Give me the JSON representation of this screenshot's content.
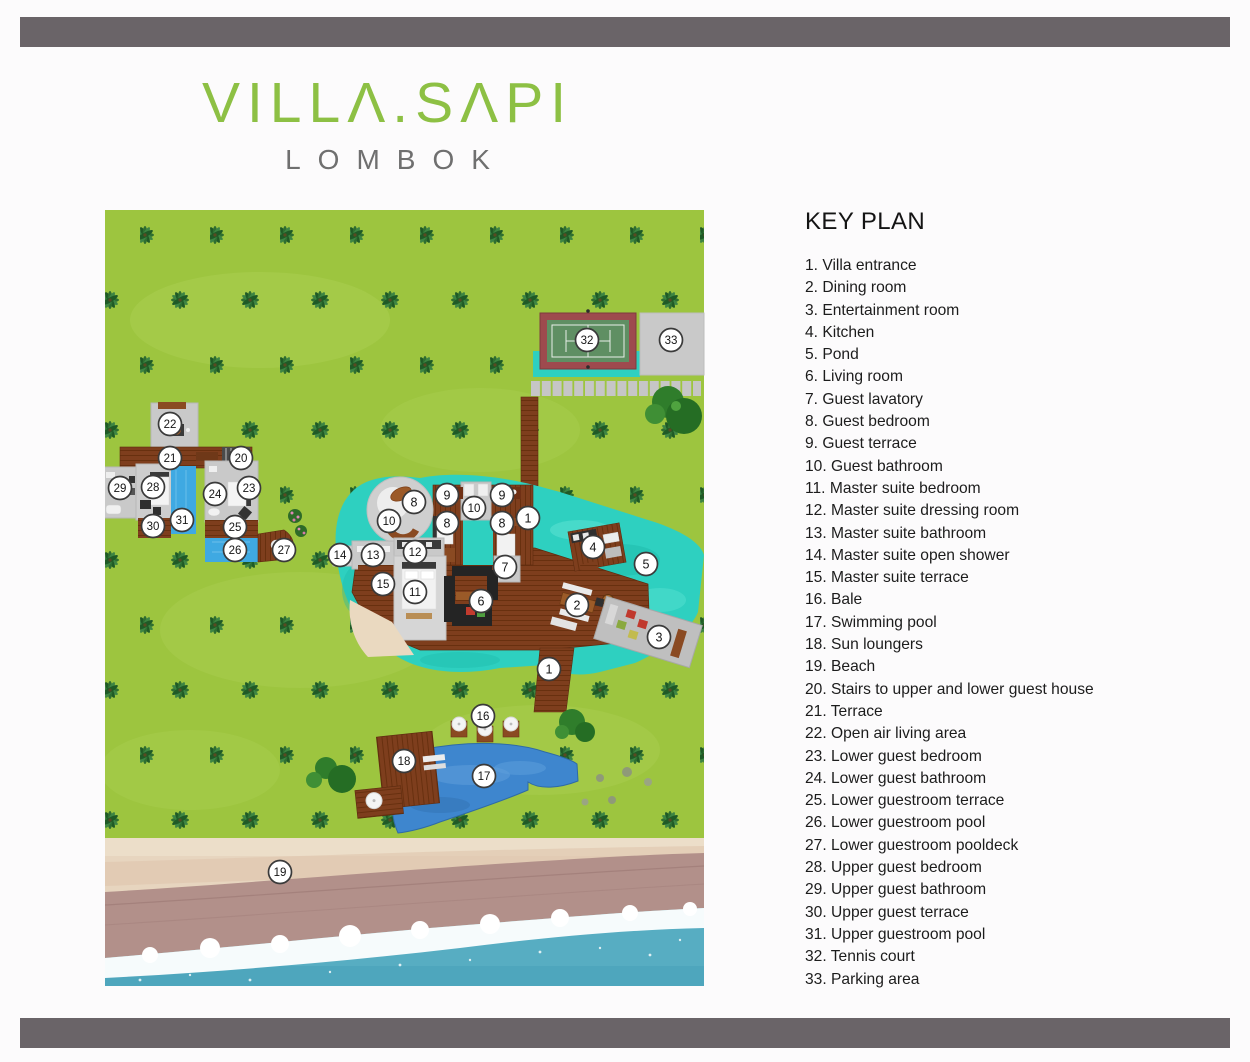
{
  "page": {
    "background": "#fcfbfc",
    "bar_color": "#6a6468"
  },
  "logo": {
    "text": "VILLA.SAPI",
    "display": "VILLΛ.SΛPI",
    "subtitle": "LOMBOK",
    "color": "#8dc044",
    "subtitle_color": "#6f6f6f"
  },
  "key_plan": {
    "title": "KEY PLAN",
    "items": [
      {
        "n": 1,
        "label": "Villa entrance"
      },
      {
        "n": 2,
        "label": "Dining room"
      },
      {
        "n": 3,
        "label": "Entertainment room"
      },
      {
        "n": 4,
        "label": "Kitchen"
      },
      {
        "n": 5,
        "label": "Pond"
      },
      {
        "n": 6,
        "label": "Living room"
      },
      {
        "n": 7,
        "label": "Guest lavatory"
      },
      {
        "n": 8,
        "label": "Guest bedroom"
      },
      {
        "n": 9,
        "label": "Guest terrace"
      },
      {
        "n": 10,
        "label": "Guest bathroom"
      },
      {
        "n": 11,
        "label": "Master suite bedroom"
      },
      {
        "n": 12,
        "label": "Master suite dressing room"
      },
      {
        "n": 13,
        "label": "Master suite bathroom"
      },
      {
        "n": 14,
        "label": "Master suite open shower"
      },
      {
        "n": 15,
        "label": "Master suite terrace"
      },
      {
        "n": 16,
        "label": "Bale"
      },
      {
        "n": 17,
        "label": "Swimming pool"
      },
      {
        "n": 18,
        "label": "Sun loungers"
      },
      {
        "n": 19,
        "label": "Beach"
      },
      {
        "n": 20,
        "label": "Stairs to upper and lower guest house"
      },
      {
        "n": 21,
        "label": "Terrace"
      },
      {
        "n": 22,
        "label": "Open air living area"
      },
      {
        "n": 23,
        "label": "Lower guest bedroom"
      },
      {
        "n": 24,
        "label": "Lower guest bathroom"
      },
      {
        "n": 25,
        "label": "Lower guestroom terrace"
      },
      {
        "n": 26,
        "label": "Lower guestroom pool"
      },
      {
        "n": 27,
        "label": "Lower guestroom pooldeck"
      },
      {
        "n": 28,
        "label": "Upper guest bedroom"
      },
      {
        "n": 29,
        "label": "Upper guest bathroom"
      },
      {
        "n": 30,
        "label": "Upper guest terrace"
      },
      {
        "n": 31,
        "label": "Upper guestroom pool"
      },
      {
        "n": 32,
        "label": "Tennis court"
      },
      {
        "n": 33,
        "label": "Parking area"
      }
    ]
  },
  "map": {
    "colors": {
      "grass": "#9dc53f",
      "pond": "#2ed0c0",
      "pool_blue": "#3e86ce",
      "guest_pool_blue": "#3fa9e2",
      "deck_brown": "#7e3e1d",
      "building_gray": "#c9c9c9",
      "tennis_border": "#9e4a4e",
      "tennis_court": "#5f8f63",
      "parking_gray": "#c9c9c9",
      "sand": "#e7d5bf",
      "wet_sand": "#b2908a",
      "ocean": "#57adc2"
    },
    "markers": [
      {
        "n": "32",
        "x": 587,
        "y": 340
      },
      {
        "n": "33",
        "x": 671,
        "y": 340
      },
      {
        "n": "22",
        "x": 170,
        "y": 424
      },
      {
        "n": "21",
        "x": 170,
        "y": 458
      },
      {
        "n": "20",
        "x": 241,
        "y": 458
      },
      {
        "n": "29",
        "x": 120,
        "y": 488
      },
      {
        "n": "28",
        "x": 153,
        "y": 487
      },
      {
        "n": "24",
        "x": 215,
        "y": 494
      },
      {
        "n": "23",
        "x": 249,
        "y": 488
      },
      {
        "n": "31",
        "x": 182,
        "y": 520
      },
      {
        "n": "30",
        "x": 153,
        "y": 526
      },
      {
        "n": "25",
        "x": 235,
        "y": 527
      },
      {
        "n": "26",
        "x": 235,
        "y": 550
      },
      {
        "n": "27",
        "x": 284,
        "y": 550
      },
      {
        "n": "8",
        "x": 414,
        "y": 502
      },
      {
        "n": "10",
        "x": 389,
        "y": 521
      },
      {
        "n": "9",
        "x": 447,
        "y": 495
      },
      {
        "n": "10",
        "x": 474,
        "y": 508
      },
      {
        "n": "8",
        "x": 447,
        "y": 523
      },
      {
        "n": "9",
        "x": 502,
        "y": 495
      },
      {
        "n": "8",
        "x": 502,
        "y": 523
      },
      {
        "n": "1",
        "x": 528,
        "y": 518
      },
      {
        "n": "7",
        "x": 505,
        "y": 567
      },
      {
        "n": "14",
        "x": 340,
        "y": 555
      },
      {
        "n": "13",
        "x": 373,
        "y": 555
      },
      {
        "n": "12",
        "x": 415,
        "y": 552
      },
      {
        "n": "15",
        "x": 383,
        "y": 584
      },
      {
        "n": "11",
        "x": 415,
        "y": 592
      },
      {
        "n": "6",
        "x": 481,
        "y": 601
      },
      {
        "n": "4",
        "x": 593,
        "y": 547
      },
      {
        "n": "5",
        "x": 646,
        "y": 564
      },
      {
        "n": "2",
        "x": 577,
        "y": 605
      },
      {
        "n": "3",
        "x": 659,
        "y": 637
      },
      {
        "n": "1",
        "x": 549,
        "y": 669
      },
      {
        "n": "16",
        "x": 483,
        "y": 716
      },
      {
        "n": "18",
        "x": 404,
        "y": 761
      },
      {
        "n": "17",
        "x": 484,
        "y": 776
      },
      {
        "n": "19",
        "x": 280,
        "y": 872
      }
    ]
  }
}
